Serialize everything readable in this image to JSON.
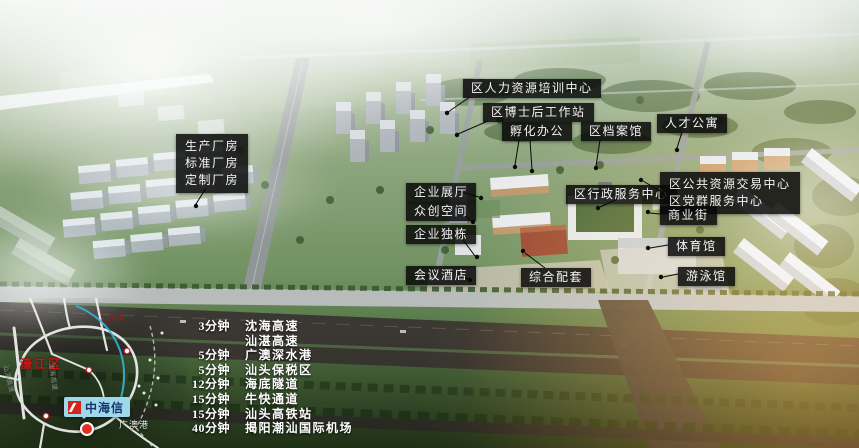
{
  "scene_title": "产业园区鸟瞰图",
  "labels": {
    "factory_lines": [
      "生产厂房",
      "标准厂房",
      "定制厂房"
    ],
    "hr_center": "区人力资源培训中心",
    "postdoc_station": "区博士后工作站",
    "incubator_office": "孵化办公",
    "archives": "区档案馆",
    "talent_apartment": "人才公寓",
    "enterprise_hall": "企业展厅",
    "maker_space": "众创空间",
    "enterprise_building": "企业独栋",
    "conference_hotel": "会议酒店",
    "mixed_support": "综合配套",
    "admin_center": "区行政服务中心",
    "public_resource_lines": [
      "区公共资源交易中心",
      "区党群服务中心"
    ],
    "commercial_street": "商业街",
    "gymnasium": "体育馆",
    "natatorium": "游泳馆"
  },
  "travel": {
    "rows": [
      {
        "time": "3分钟",
        "dest": "沈海高速"
      },
      {
        "time": "",
        "dest": "汕湛高速"
      },
      {
        "time": "5分钟",
        "dest": "广澳深水港"
      },
      {
        "time": "5分钟",
        "dest": "汕头保税区"
      },
      {
        "time": "12分钟",
        "dest": "海底隧道"
      },
      {
        "time": "15分钟",
        "dest": "牛快通道"
      },
      {
        "time": "15分钟",
        "dest": "汕头高铁站"
      },
      {
        "time": "40分钟",
        "dest": "揭阳潮汕国际机场"
      }
    ]
  },
  "minimap": {
    "district": "濠江区",
    "bay": "汕头湾",
    "port": "广澳港",
    "brand": "中海信",
    "expressway_left": "汕湛高速",
    "expressway_center": "沈海高速"
  },
  "icons": {
    "brand_logo": "zhonghaixin-red-square-logo",
    "pin": "location-pin"
  },
  "colors": {
    "label_bg": "rgba(8,8,8,0.85)",
    "label_text": "#f5f5f5",
    "brand_bubble": "#9fd9e9",
    "brand_text": "#16336d",
    "brand_logo_red": "#d42318",
    "map_red": "#d01212",
    "pin_red": "#e03022"
  }
}
